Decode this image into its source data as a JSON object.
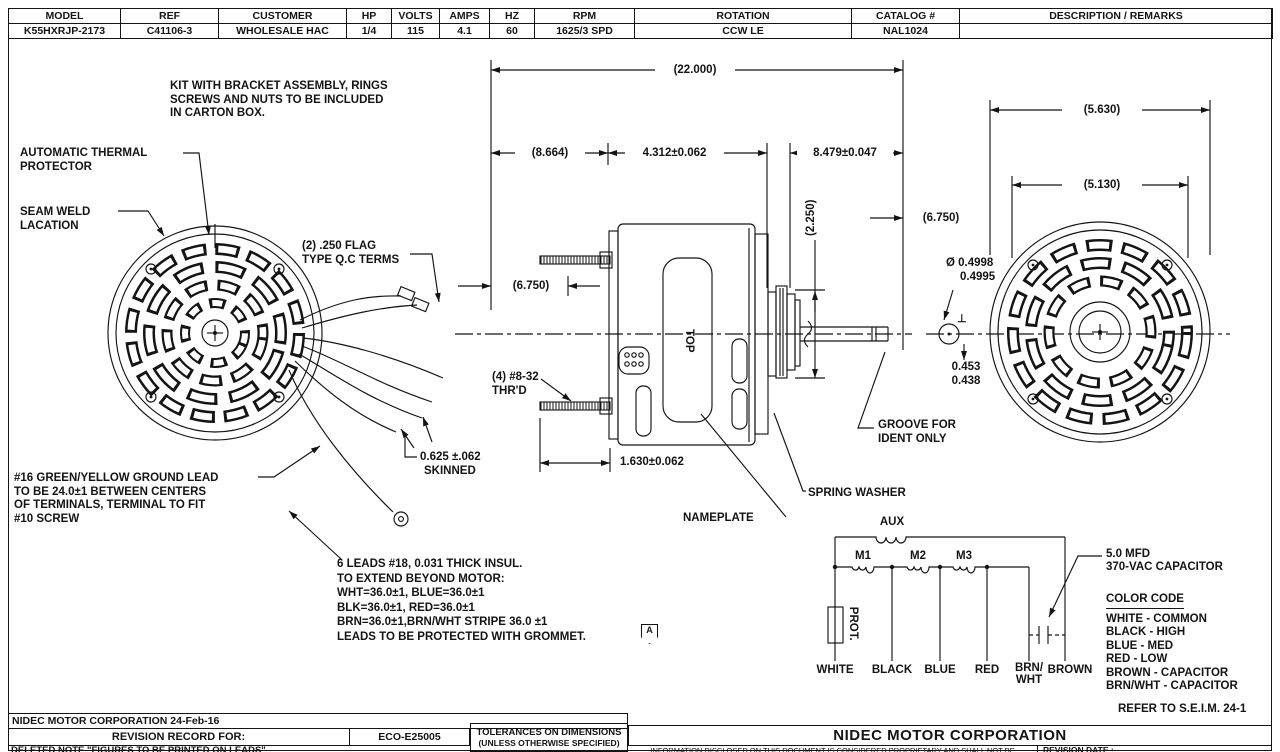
{
  "title_block": {
    "columns": [
      {
        "label": "MODEL",
        "value": "K55HXRJP-2173"
      },
      {
        "label": "REF",
        "value": "C41106-3"
      },
      {
        "label": "CUSTOMER",
        "value": "WHOLESALE HAC"
      },
      {
        "label": "HP",
        "value": "1/4"
      },
      {
        "label": "VOLTS",
        "value": "115"
      },
      {
        "label": "AMPS",
        "value": "4.1"
      },
      {
        "label": "HZ",
        "value": "60"
      },
      {
        "label": "RPM",
        "value": "1625/3 SPD"
      },
      {
        "label": "ROTATION",
        "value": "CCW LE"
      },
      {
        "label": "CATALOG #",
        "value": "NAL1024"
      },
      {
        "label": "DESCRIPTION / REMARKS",
        "value": ""
      }
    ]
  },
  "notes": {
    "kit": "KIT WITH BRACKET ASSEMBLY, RINGS\nSCREWS AND NUTS TO BE INCLUDED\nIN CARTON BOX.",
    "thermal": "AUTOMATIC THERMAL\nPROTECTOR",
    "seam": "SEAM WELD\nLACATION",
    "flag_terms": "(2) .250 FLAG\nTYPE Q.C TERMS",
    "ground": "#16 GREEN/YELLOW GROUND LEAD\nTO BE 24.0±1 BETWEEN CENTERS\nOF TERMINALS, TERMINAL TO FIT\n#10 SCREW",
    "leads": "6 LEADS #18, 0.031 THICK INSUL.\nTO EXTEND BEYOND MOTOR:\nWHT=36.0±1, BLUE=36.0±1\nBLK=36.0±1, RED=36.0±1\nBRN=36.0±1,BRN/WHT STRIPE 36.0 ±1\nLEADS TO BE PROTECTED WITH GROMMET.",
    "rev_flag": "A",
    "thread": "(4) #8-32\nTHR'D",
    "nameplate": "NAMEPLATE",
    "spring_washer": "SPRING WASHER",
    "groove": "GROOVE FOR\nIDENT ONLY",
    "top_marking": "TOP"
  },
  "dimensions": {
    "overall": "(22.000)",
    "d8664": "(8.664)",
    "d4312": "4.312±0.062",
    "d8479": "8.479±0.047",
    "d5630": "(5.630)",
    "d5130": "(5.130)",
    "d6750_left": "(6.750)",
    "d6750_right": "(6.750)",
    "d2250": "(2.250)",
    "shaft_dia_1": "Ø 0.4998",
    "shaft_dia_2": "0.4995",
    "flat_1": "0.453",
    "flat_2": "0.438",
    "perp": "⊥",
    "d1630": "1.630±0.062",
    "skinned_1": "0.625 ±.062",
    "skinned_2": "SKINNED"
  },
  "schematic": {
    "aux": "AUX",
    "m1": "M1",
    "m2": "M2",
    "m3": "M3",
    "prot": "PROT.",
    "wires": [
      "WHITE",
      "BLACK",
      "BLUE",
      "RED",
      "BRN/\nWHT",
      "BROWN"
    ],
    "capacitor_note": "5.0 MFD\n370-VAC CAPACITOR"
  },
  "color_code": {
    "title": "COLOR CODE",
    "items": [
      "WHITE - COMMON",
      "BLACK - HIGH",
      "BLUE - MED",
      "RED - LOW",
      "BROWN - CAPACITOR",
      "BRN/WHT - CAPACITOR"
    ]
  },
  "footer": {
    "company_date": "NIDEC MOTOR CORPORATION 24-Feb-16",
    "refer": "REFER TO S.E.I.M. 24-1",
    "revision_record_label": "REVISION RECORD FOR:",
    "eco": "ECO-E25005",
    "tolerances_1": "TOLERANCES ON DIMENSIONS",
    "tolerances_2": "(UNLESS OTHERWISE SPECIFIED)",
    "deleted_note": "DELETED NOTE \"FIGURES TO BE PRINTED ON LEADS\"",
    "company_title": "NIDEC MOTOR CORPORATION",
    "proprietary": "INFORMATION DISCLOSED ON THIS DOCUMENT IS CONSIDERED PROPRIETARY AND SHALL NOT BE",
    "revision_date_label": "REVISION DATE :"
  }
}
